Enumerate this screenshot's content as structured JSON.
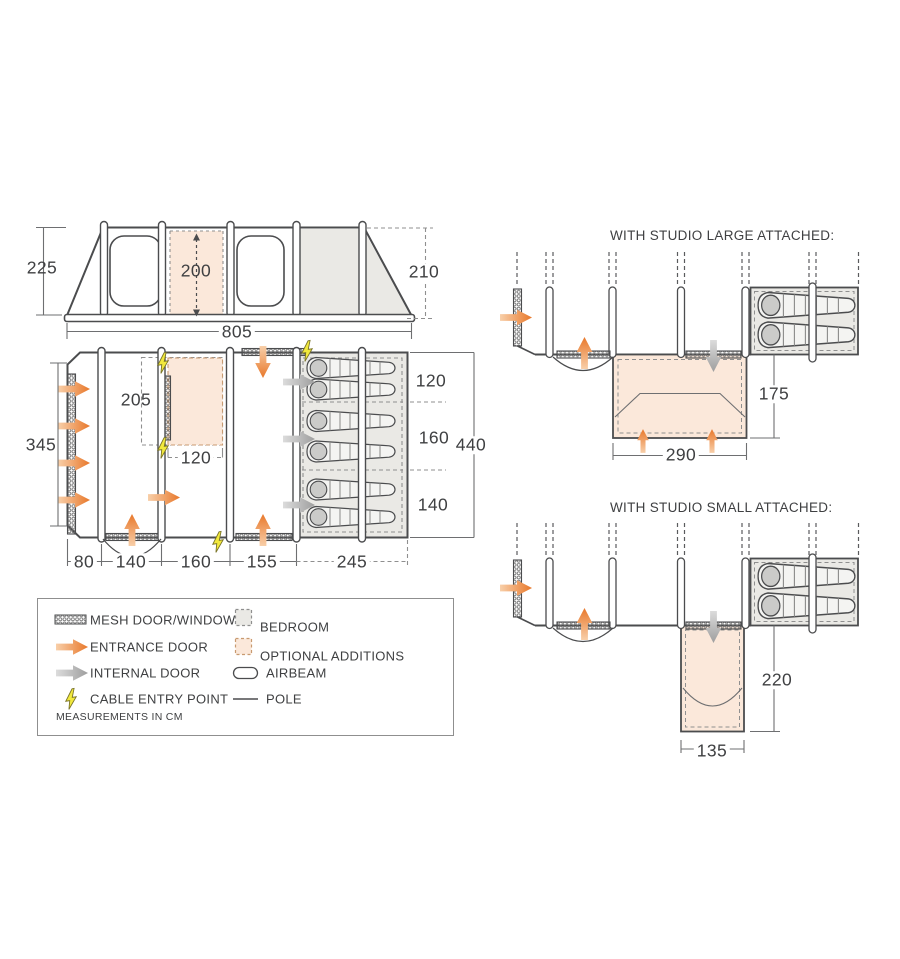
{
  "diagram": {
    "side_view": {
      "height_left": "225",
      "interior_height": "200",
      "height_right": "210",
      "total_width": "805"
    },
    "floor_plan": {
      "width_left": "345",
      "bedroom_inner_depth": "205",
      "optional_width": "120",
      "bedroom_sections": [
        "120",
        "160",
        "140"
      ],
      "total_depth": "440",
      "bottom_widths": [
        "80",
        "140",
        "160",
        "155",
        "245"
      ]
    },
    "studio_large": {
      "title": "WITH STUDIO LARGE ATTACHED:",
      "width": "290",
      "depth": "175"
    },
    "studio_small": {
      "title": "WITH STUDIO SMALL ATTACHED:",
      "width": "135",
      "depth": "220"
    }
  },
  "legend": {
    "items": [
      {
        "label": "MESH DOOR/WINDOW"
      },
      {
        "label": "ENTRANCE DOOR"
      },
      {
        "label": "INTERNAL DOOR"
      },
      {
        "label": "CABLE ENTRY POINT"
      },
      {
        "label": "BEDROOM"
      },
      {
        "label": "OPTIONAL ADDITIONS"
      },
      {
        "label": "AIRBEAM"
      },
      {
        "label": "POLE"
      }
    ],
    "note": "MEASUREMENTS IN CM"
  },
  "colors": {
    "line": "#4b4c4e",
    "orange": "#e8782b",
    "orange_light": "#f8cfa9",
    "peach_fill": "#fbe8da",
    "gray_fill": "#eae9e5",
    "internal_arrow": "#9e9e9e",
    "cable_yellow": "#f2e93d"
  }
}
